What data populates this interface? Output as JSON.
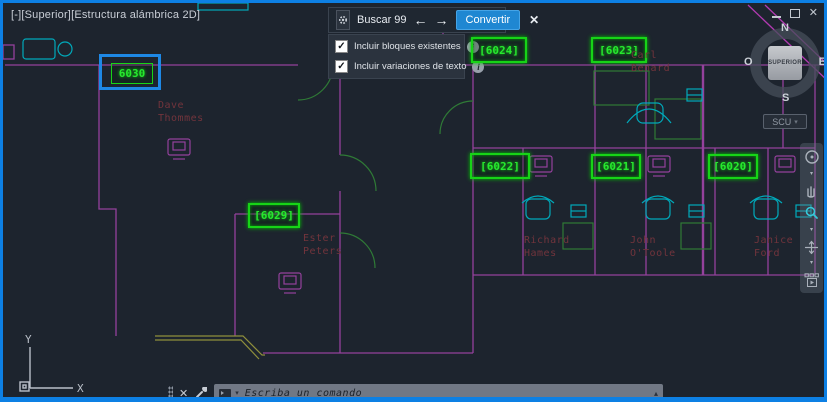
{
  "viewport": {
    "label": "[-][Superior][Estructura alámbrica 2D]"
  },
  "icons": {
    "check": "✓",
    "info": "i",
    "prev": "←",
    "next": "→",
    "close": "✕",
    "caret_down": "▾",
    "caret_up": "▴"
  },
  "find_toolbar": {
    "search_label": "Buscar 99",
    "convert_label": "Convertir"
  },
  "options_panel": {
    "items": [
      {
        "label": "Incluir bloques existentes",
        "checked": true
      },
      {
        "label": "Incluir variaciones de texto",
        "checked": true
      }
    ]
  },
  "viewcube": {
    "n": "N",
    "s": "S",
    "e": "E",
    "w": "O",
    "face": "SUPERIOR",
    "ucs_button": "SCU"
  },
  "command_bar": {
    "placeholder": "Escriba un comando"
  },
  "ucs_icon": {
    "x": "X",
    "y": "Y"
  },
  "plan": {
    "tags": [
      {
        "display": "6030",
        "selected": true
      },
      {
        "display": "[6029]"
      },
      {
        "display": "[6024]"
      },
      {
        "display": "[6023]"
      },
      {
        "display": "[6022]"
      },
      {
        "display": "[6021]"
      },
      {
        "display": "[6020]"
      }
    ],
    "names": [
      {
        "text": "Dave\nThommes"
      },
      {
        "text": "Ester\nPeters"
      },
      {
        "text": "Richard\nHames"
      },
      {
        "text": "John\nO'Toole"
      },
      {
        "text": "Janice\nFord"
      },
      {
        "text": "Carl\nBenard"
      }
    ]
  },
  "colors": {
    "accent_blue": "#1f87d2",
    "selection_blue": "#1e88e5",
    "highlight_green": "#1fe01f",
    "wall_purple": "#94419c",
    "furniture_cyan": "#00a9ba",
    "label_red": "#72343c",
    "frame_blue": "#0d80e4"
  }
}
